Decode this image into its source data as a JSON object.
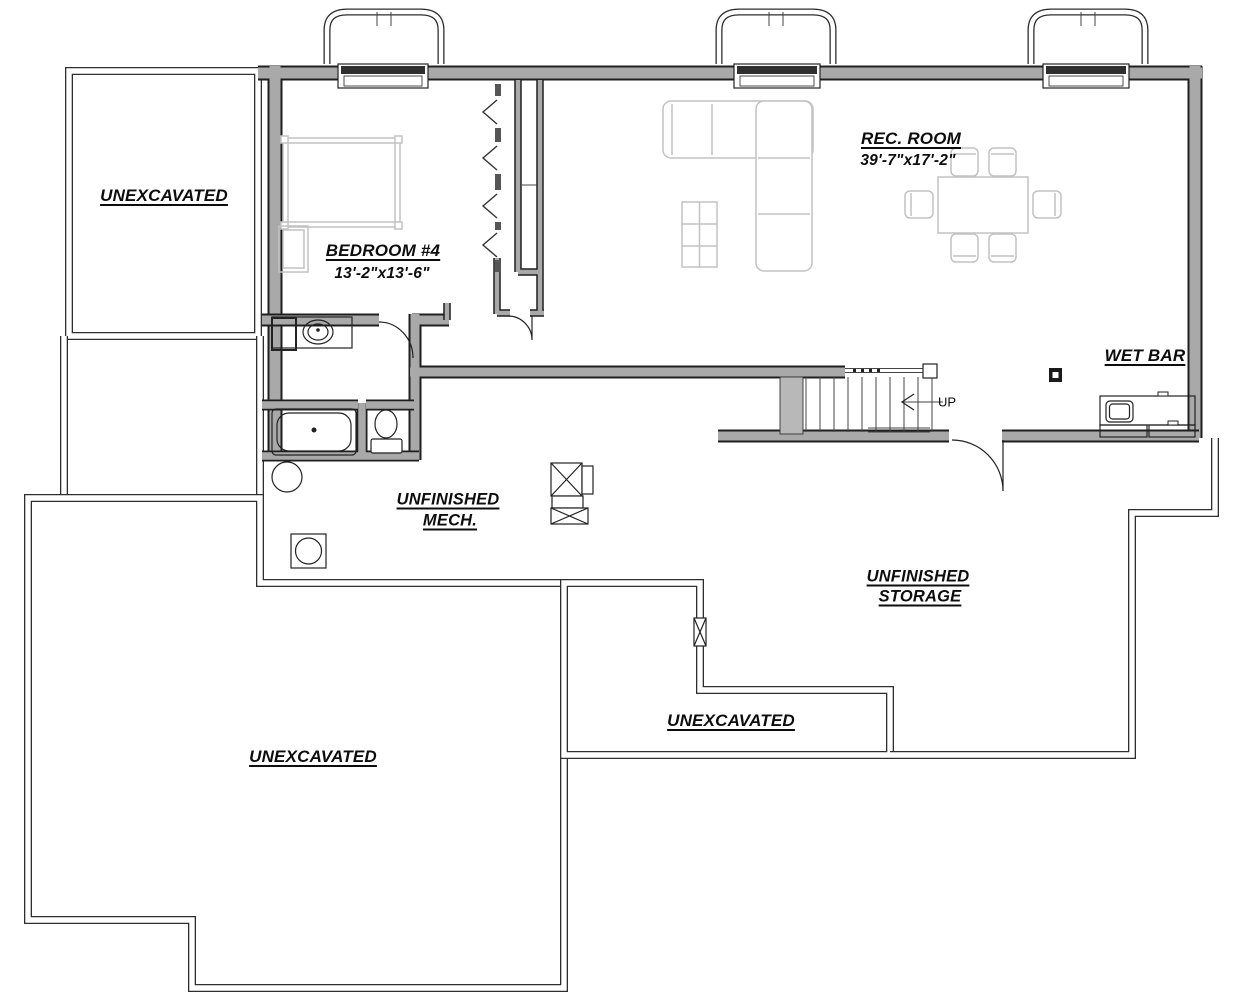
{
  "plan": {
    "labels": {
      "unexcavated_nw": "UNEXCAVATED",
      "unexcavated_sw": "UNEXCAVATED",
      "unexcavated_mid": "UNEXCAVATED",
      "bedroom_name": "BEDROOM #4",
      "bedroom_dims": "13'-2\"x13'-6\"",
      "rec_room_name": "REC. ROOM",
      "rec_room_dims": "39'-7\"x17'-2\"",
      "wet_bar": "WET BAR",
      "mech_line1": "UNFINISHED",
      "mech_line2": "MECH.",
      "storage_line1": "UNFINISHED",
      "storage_line2": "STORAGE",
      "stairs_direction": "UP"
    },
    "colors": {
      "wall_core_gray": "#a9a9a9",
      "wall_edge": "#1f1f1f",
      "foundation_line": "#2e2e2e",
      "furniture_gray": "#c2c2c2",
      "text": "#0d0d0d",
      "background": "#ffffff"
    }
  }
}
